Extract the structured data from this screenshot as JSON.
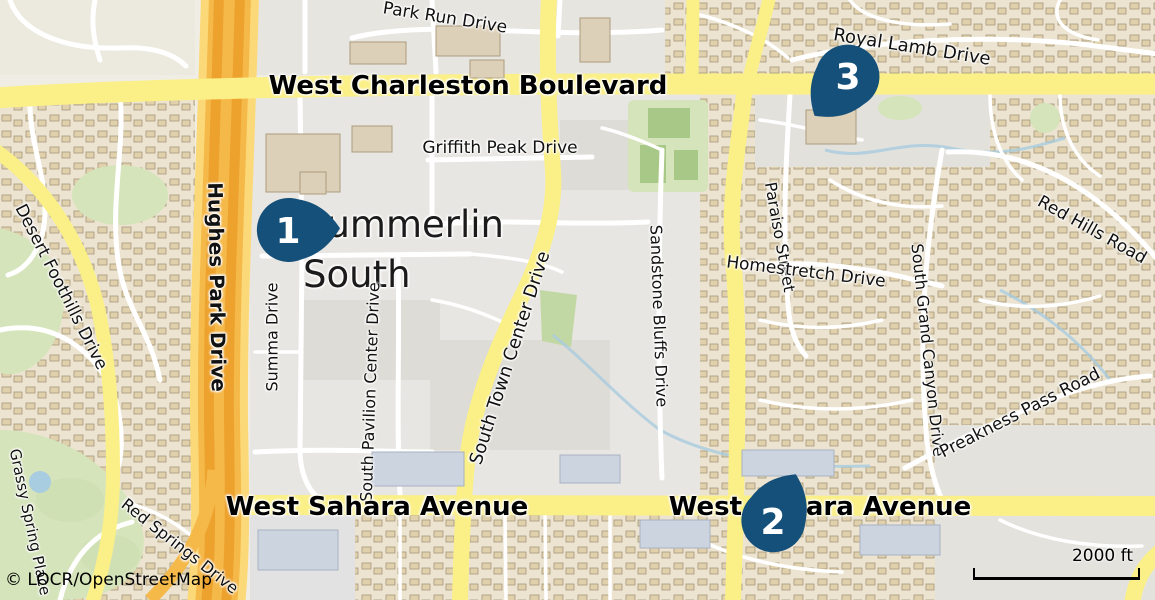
{
  "map": {
    "place": {
      "summerlin_south": "Summerlin\nSouth"
    },
    "labels": {
      "park_run": {
        "text": "Park Run Drive"
      },
      "charleston": {
        "text": "West Charleston Boulevard"
      },
      "royal_lamb": {
        "text": "Royal Lamb Drive"
      },
      "hughes_park": {
        "text": "Hughes Park Drive"
      },
      "desert_foothills": {
        "text": "Desert Foothills Drive"
      },
      "griffith_peak": {
        "text": "Griffith Peak Drive"
      },
      "town_center": {
        "text": "South Town Center Drive"
      },
      "summa": {
        "text": "Summa Drive"
      },
      "pavilion": {
        "text": "South Pavilion Center Drive"
      },
      "sandstone": {
        "text": "Sandstone Bluffs Drive"
      },
      "paraiso": {
        "text": "Paraiso Street"
      },
      "homestretch": {
        "text": "Homestretch Drive"
      },
      "red_hills": {
        "text": "Red Hills Road"
      },
      "grand_canyon": {
        "text": "South Grand Canyon Drive"
      },
      "preakness": {
        "text": "Preakness Pass Road"
      },
      "sahara_left": {
        "text": "West Sahara Avenue"
      },
      "sahara_right": {
        "text": "West Sahara Avenue"
      },
      "red_springs": {
        "text": "Red Springs Drive"
      },
      "grassy_spring": {
        "text": "Grassy Spring Place"
      }
    },
    "markers": [
      {
        "number": "1",
        "x": 288,
        "y": 230,
        "angle": -3
      },
      {
        "number": "2",
        "x": 773,
        "y": 521,
        "angle": -65
      },
      {
        "number": "3",
        "x": 848,
        "y": 76,
        "angle": 129
      }
    ],
    "scale": {
      "label": "2000 ft"
    },
    "attribution": "© LOCR/OpenStreetMap",
    "colors": {
      "marker": "#14507a",
      "road_yellow": "#fbf087",
      "freeway": "#f5b94a",
      "freeway_dark": "#eda22e",
      "freeway_edge": "#fcd978",
      "water": "#a8cce0",
      "park": "#d5e4ba"
    }
  }
}
